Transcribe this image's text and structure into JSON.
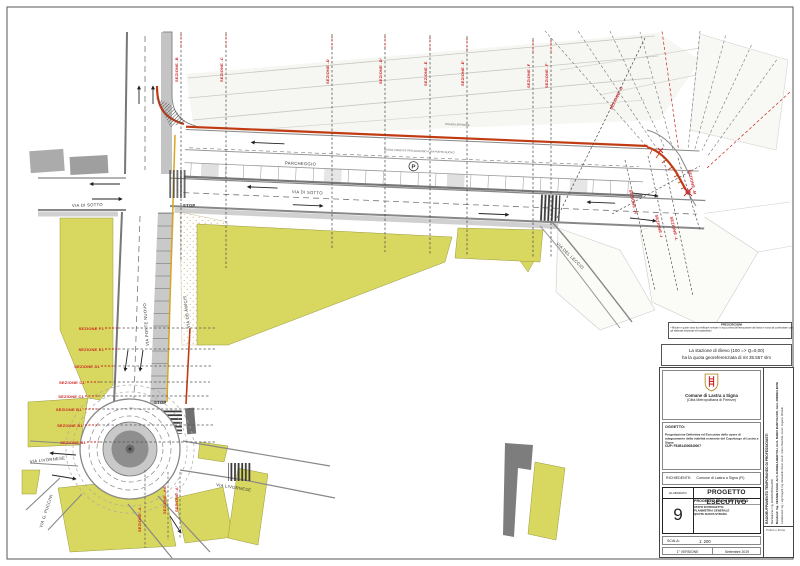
{
  "colors": {
    "accent_red": "#c03a12",
    "section_red": "#cc2222",
    "building_yellow": "#d8d75f"
  },
  "map": {
    "labels": {
      "nuova_viabilita": "NUOVA VIABILITA' PER ACCESSO A VIA PONTE NUOVO",
      "parcheggio": "PARCHEGGIO",
      "parking_p": "P",
      "via_di_sotto": "VIA DI SOTTO",
      "stop": "STOP",
      "via_ponte_nuovo": "VIA PONTE NUOVO",
      "via_de_amicis": "VIA DE AMICIS",
      "via_livornese": "VIA LIVORNESE",
      "via_g_puccini": "VIA G. PUCCINI",
      "via_del_leccio": "VIA DEL LECCIO",
      "strada_note": "STRADA SPERONE"
    },
    "sections_top": [
      "SEZIONE -B",
      "SEZIONE -C",
      "SEZIONE -D",
      "SEZIONE -D'",
      "SEZIONE -E",
      "SEZIONE -E'",
      "SEZIONE -F",
      "SEZIONE -F'",
      "SEZIONE -G"
    ],
    "sections_left": [
      "SEZIONE F1",
      "SEZIONE E1",
      "SEZIONE D1",
      "SEZIONE C1'",
      "SEZIONE C1",
      "SEZIONE B1''",
      "SEZIONE B1'",
      "SEZIONE B1"
    ],
    "sections_right": [
      "SEZIONE -H",
      "SEZIONE -I",
      "SEZIONE -L",
      "SEZIONE -M"
    ],
    "sections_roundabout": [
      "SEZIONE -A",
      "SEZIONE -AA",
      "SEZIONE -A'"
    ]
  },
  "notes": {
    "prescrizioni_title": "PRESCRIZIONI",
    "prescrizioni_text": "• Misure e quote sono da verificare sempre in loco prima dell'esecuzione dei lavori e sono da confrontare con gli elaborati strutturali ed impiantistici.",
    "station_line1": "La stazione di rilievo (100 => Q=0,00)",
    "station_line2": "ha la quota georeferenziata di mt 35.557 slm"
  },
  "titleblock": {
    "commune_line1": "Comune di Lastra a Signa",
    "commune_line2": "(Città Metropolitana di Firenze)",
    "oggetto_label": "OGGETTO:",
    "oggetto_text": "Progettazione Definitiva ed Esecutiva delle opere di adeguamento della viabilità esistente del Capoluogo di Lastra a Signa",
    "cup": "CUP: F81B14000840007",
    "richiedente_label": "RICHIEDENTE:",
    "richiedente_value": "Comune di Lastra a Signa  (FI)",
    "elaborato_label": "ELABORATO",
    "project_title": "PROGETTO ESECUTIVO",
    "project_subtitle": "PROGETTO ARCHITETTONICO",
    "stato_label": "STATO DI PROGETTO:",
    "stato_line2": "PLANIMETRIA GENERALE",
    "stato_line3": "QUOTE NUOVA STRADA",
    "number": "9",
    "scala_label": "SCALA:",
    "scala_value": "1: 200",
    "version_label": "1° VERSIONE",
    "version_date": "Settembre 2019",
    "rtp_title": "RAGGRUPPAMENTO TEMPORANEO DI PROFESSIONISTI",
    "rtp_mandataria": "Mandataria: Ing. GIANNI BOGLIONI",
    "rtp_mandanti": "Mandanti: Ing. CESARE FAGGI, Arch. DANIELA BERTOLI, Arch. MARIO BARTOLOZZI, Geol. ANDREA BONI",
    "rtp_collaboratori": "Collaboratori: Ing. Luigi Dragotti, Ing. Alessandro Bensi, Geom. Enrico Bianchini, Geom. Eugenio Morandi",
    "timbro": "Timbro e Firma"
  }
}
